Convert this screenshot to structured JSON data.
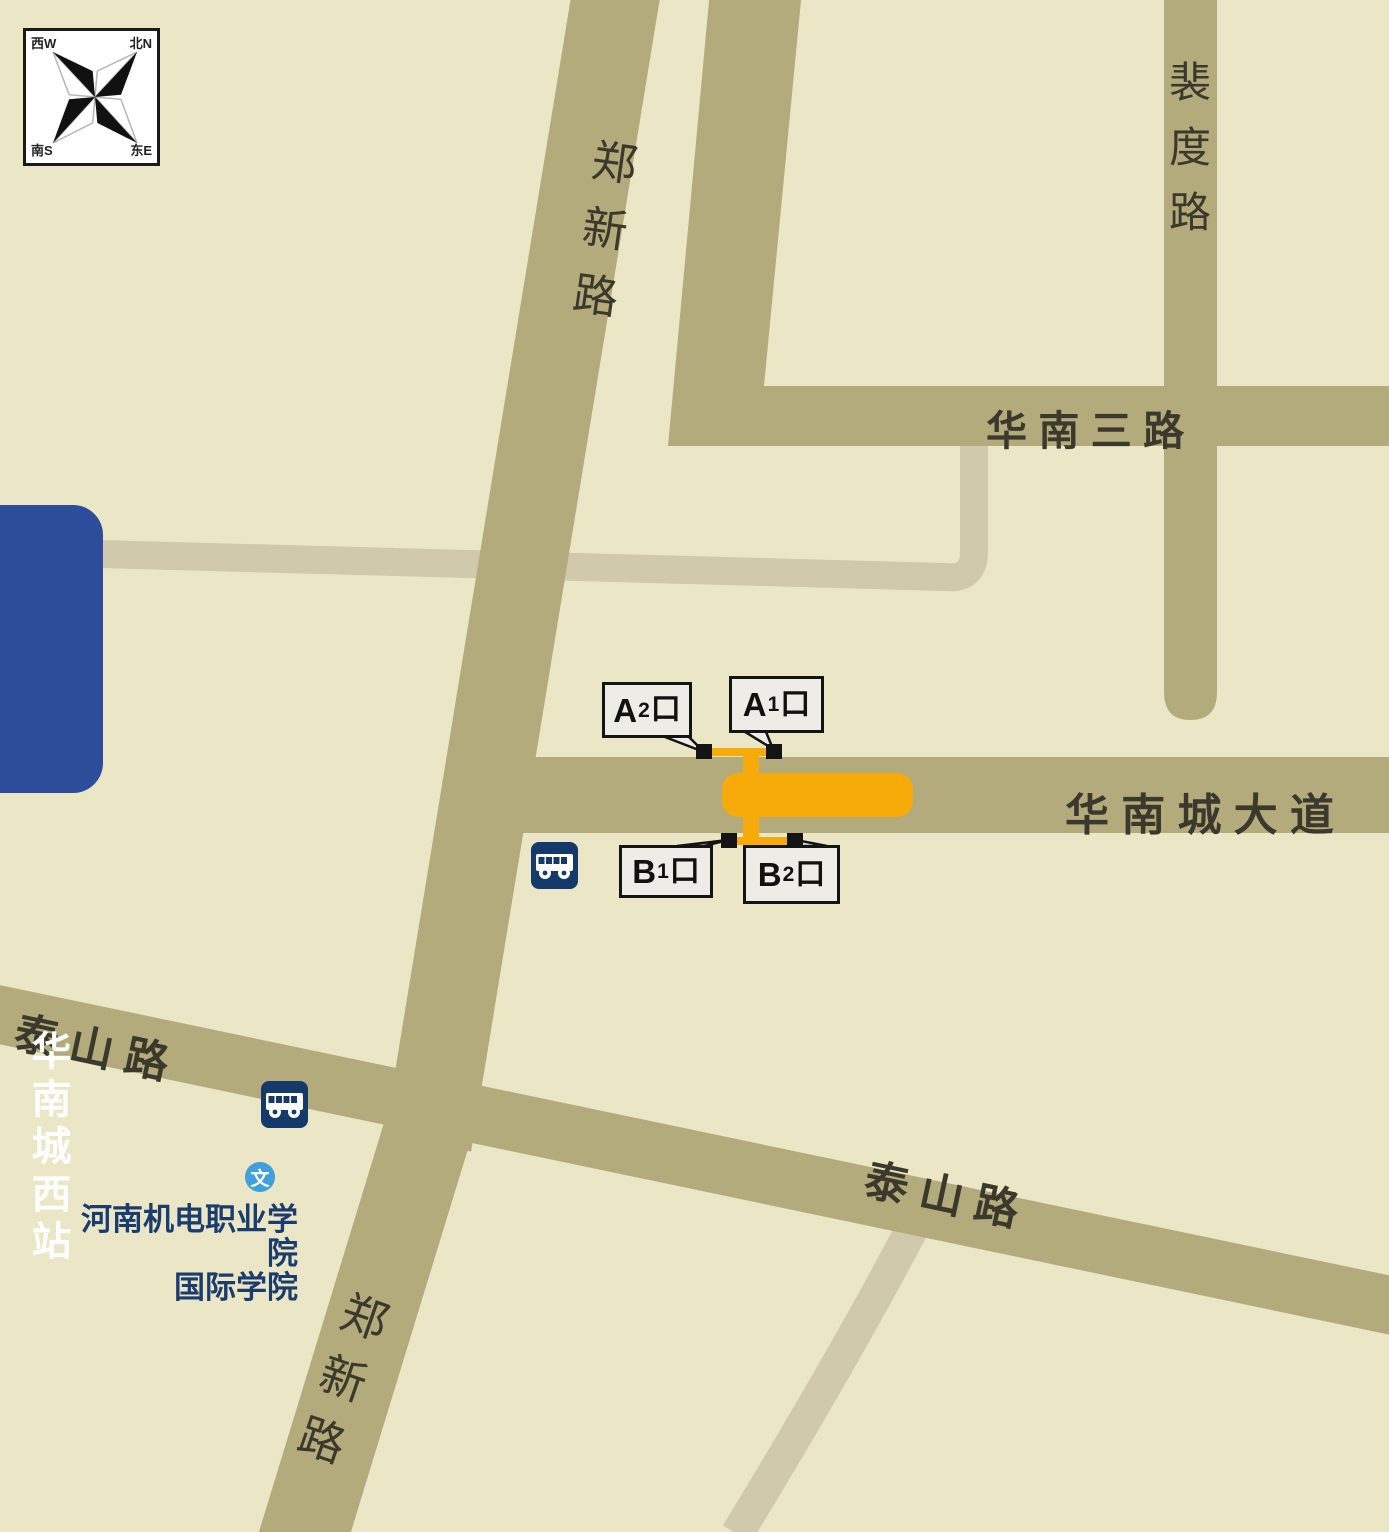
{
  "compass": {
    "nw": "西W",
    "ne": "北N",
    "sw": "南S",
    "se": "东E"
  },
  "station_badge": {
    "name": "华南城西站"
  },
  "roads": {
    "zhengxin_top": "郑新路",
    "zhengxin_bottom": "郑新路",
    "peidu": "裴度路",
    "huanan_san": "华 南 三 路",
    "huanancheng_avenue": "华 南 城 大 道",
    "taishan_west": "泰 山 路",
    "taishan_east": "泰 山 路"
  },
  "exits": {
    "a2": {
      "letter": "A",
      "num": "2",
      "suffix": "口"
    },
    "a1": {
      "letter": "A",
      "num": "1",
      "suffix": "口"
    },
    "b1": {
      "letter": "B",
      "num": "1",
      "suffix": "口"
    },
    "b2": {
      "letter": "B",
      "num": "2",
      "suffix": "口"
    }
  },
  "poi": {
    "school_marker": "文",
    "school_line1": "河南机电职业学院",
    "school_line2": "国际学院"
  },
  "colors": {
    "background": "#EBE7C6",
    "road_main": "#B4AB7D",
    "road_minor": "#D0C9AC",
    "station_orange": "#F6AB0B",
    "badge_blue": "#2D4C99",
    "bus_navy": "#143A6B",
    "school_text_navy": "#1B3C6E",
    "marker_blue": "#3FA0DB",
    "callout_bg": "#EDECE7"
  }
}
